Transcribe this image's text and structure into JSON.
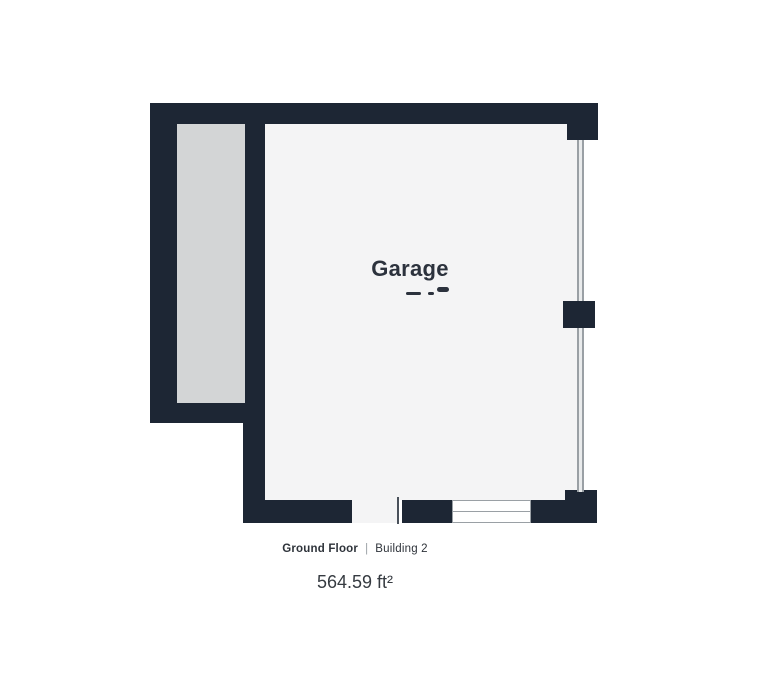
{
  "floorplan": {
    "room_label": "Garage",
    "colors": {
      "wall": "#1d2634",
      "store_fill": "#d3d5d6",
      "floor_fill": "#f4f4f5",
      "track_fill": "#e9ebec",
      "track_line": "#9aa0a5",
      "door_fill": "#ffffff",
      "door_border": "#9aa0a5",
      "label_color": "#2c323d",
      "footer_text": "#2e333a",
      "footer_separator": "#9aa0a5",
      "area_text": "#363b41"
    }
  },
  "footer": {
    "floor_label": "Ground Floor",
    "separator": "|",
    "building_label": "Building 2",
    "area_label": "564.59 ft²"
  }
}
